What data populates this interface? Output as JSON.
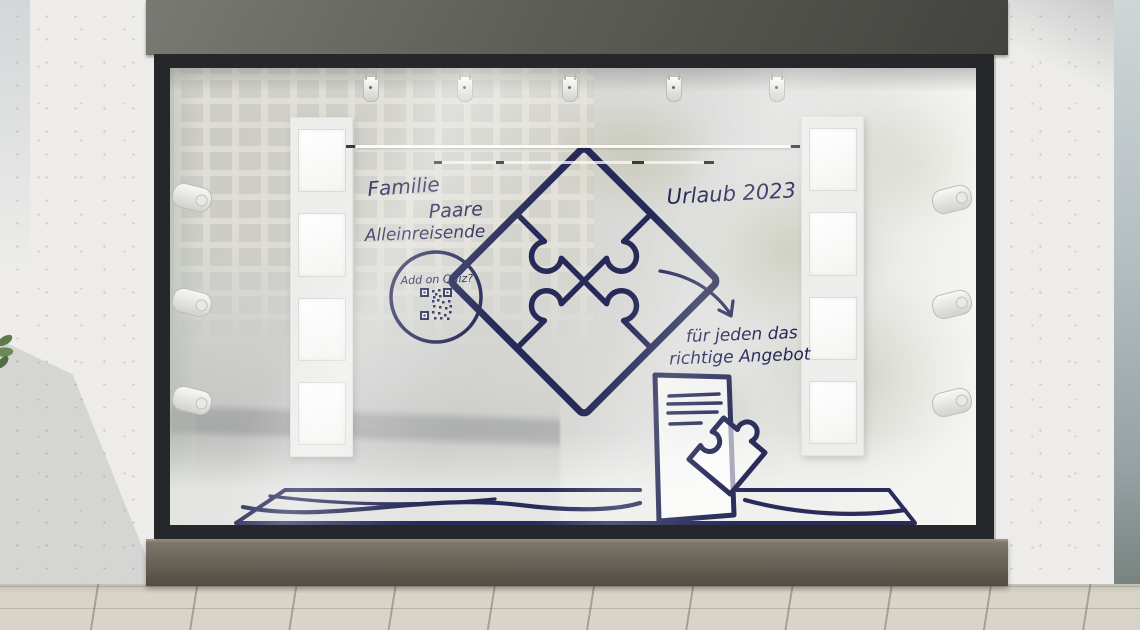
{
  "scene": {
    "type": "storefront-window-display-mockup",
    "description": "Shop window with hand-drawn travel-offer decal"
  },
  "decal": {
    "audiences": [
      {
        "label": "Familie"
      },
      {
        "label": "Paare"
      },
      {
        "label": "Alleinreisende"
      }
    ],
    "title": "Urlaub 2023",
    "quiz_badge": {
      "label": "Add on Quiz?"
    },
    "tagline": {
      "line1": "für jeden das",
      "line2": "richtige Angebot"
    }
  },
  "display": {
    "ceiling_spotlights": 5,
    "side_spotlights_left": 3,
    "side_spotlights_right": 3,
    "poster_panels": 2,
    "frames_per_panel": 4
  },
  "icons": {
    "puzzle-diamond-icon": "four interlocking jigsaw pieces rotated 45 degrees",
    "qr-code-icon": "QR code inside circle badge",
    "curved-arrow-icon": "hand-drawn curved arrow pointing to tagline",
    "flyer-icon": "document sheet with text lines",
    "puzzle-piece-icon": "single jigsaw piece overlapping flyer",
    "rug-icon": "hand-drawn rug outline on display floor",
    "spotlight-icon": "white display spotlight"
  },
  "colors": {
    "decal_navy": "#1e2152",
    "fascia_dark": "#4a4b45",
    "frame_dark": "#26272b",
    "base_bronze": "#6b655a",
    "wall_concrete": "#edecea",
    "wall_shade_blue": "#b4bdc0",
    "sidewalk": "#d8d4c7",
    "glass": "#d5d6d4",
    "panel_white": "#ededeb"
  }
}
